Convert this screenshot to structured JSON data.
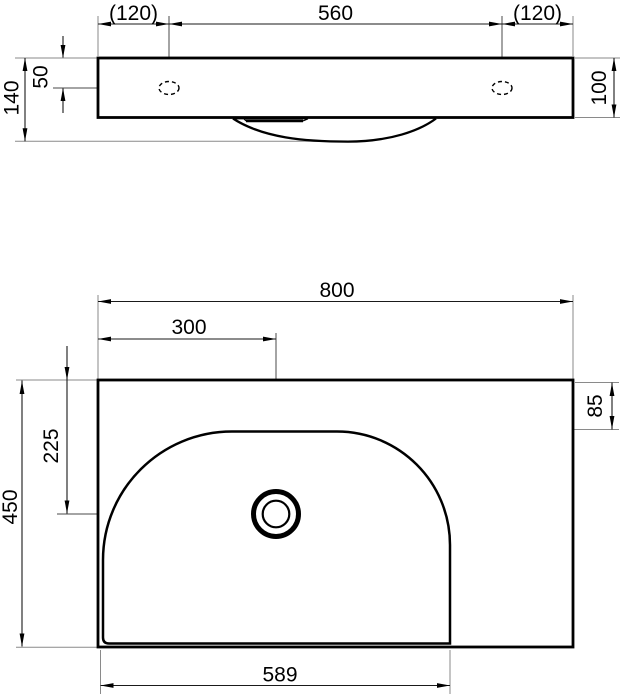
{
  "front_view": {
    "dim_hole_offset_left": "(120)",
    "dim_hole_spacing": "560",
    "dim_hole_offset_right": "(120)",
    "dim_hole_from_top": "50",
    "dim_total_height": "140",
    "dim_body_height": "100"
  },
  "plan_view": {
    "dim_width": "800",
    "dim_faucet_from_left": "300",
    "dim_faucet_from_front": "225",
    "dim_depth": "450",
    "dim_basin_top_offset": "85",
    "dim_basin_width": "589"
  },
  "colors": {
    "background": "#ffffff",
    "outline": "#000000",
    "thin_line": "#4a4a4a"
  }
}
